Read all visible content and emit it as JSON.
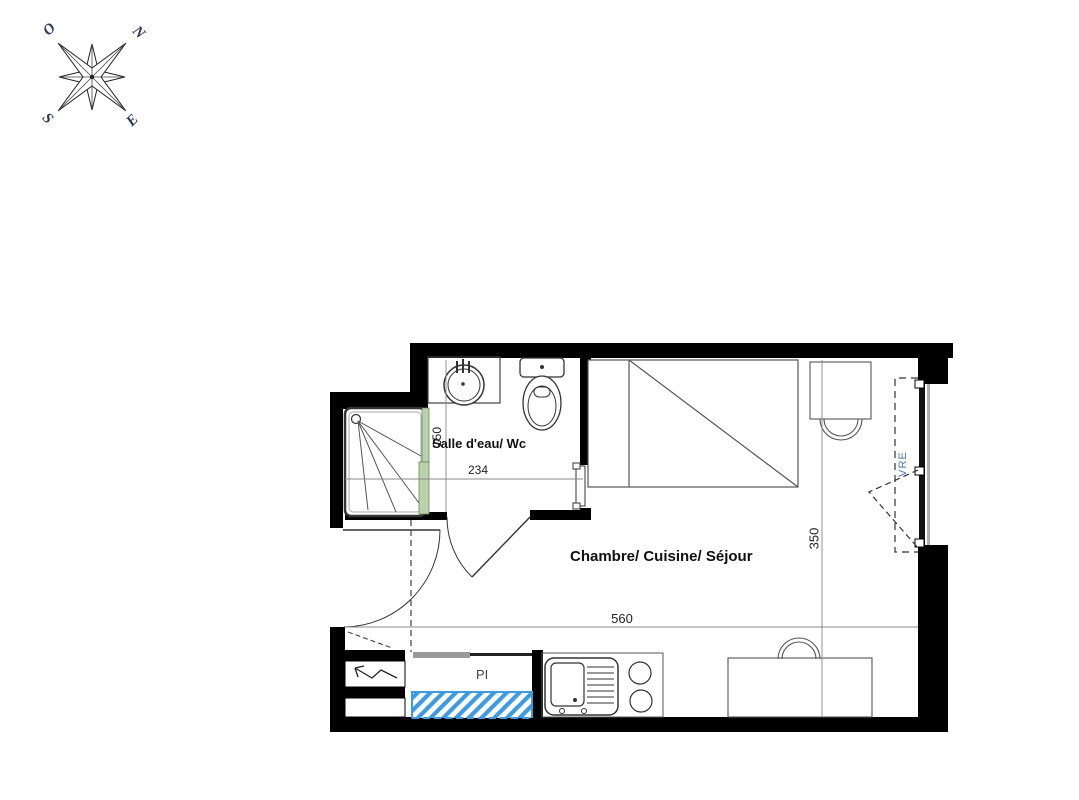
{
  "compass": {
    "west": "O",
    "north": "N",
    "south": "S",
    "east": "E"
  },
  "rooms": {
    "bathroom": {
      "label": "Salle d'eau/ Wc",
      "width_cm": "234",
      "depth_cm": "150"
    },
    "main": {
      "label": "Chambre/ Cuisine/ Séjour",
      "width_cm": "560",
      "depth_cm": "350"
    }
  },
  "annotations": {
    "closet": "PI",
    "window": "VRE"
  },
  "fixtures": [
    "shower",
    "shower-screen",
    "washbasin",
    "toilet",
    "towel-radiator",
    "bed",
    "desk",
    "desk-chair",
    "kitchen-sink",
    "cooktop",
    "dining-table",
    "dining-chair",
    "electrical-panel",
    "entry-door",
    "bathroom-door",
    "french-window",
    "technical-duct",
    "closet-rail"
  ],
  "colors": {
    "wall": "#000000",
    "duct_hatch": "#3f9be0",
    "shower_screen": "#b9d2ae",
    "window_label": "#4d7ca8",
    "compass_letters": "#2e3a54"
  }
}
